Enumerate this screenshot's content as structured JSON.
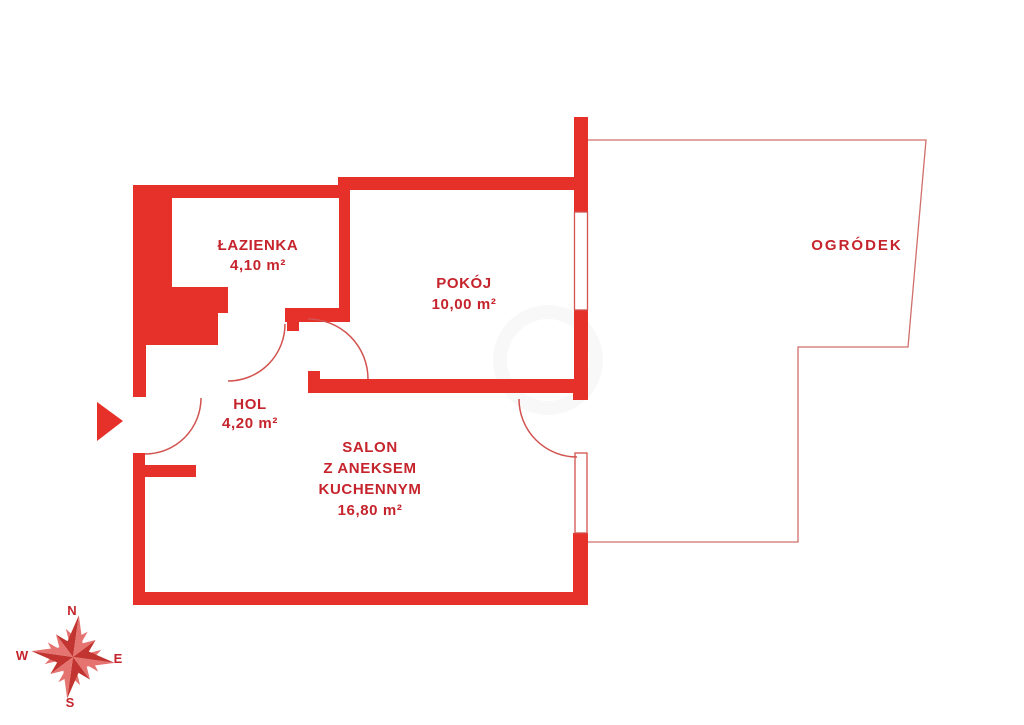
{
  "plan": {
    "rooms": [
      {
        "key": "lazienka",
        "label": "ŁAZIENKA",
        "area": "4,10 m²"
      },
      {
        "key": "pokoj",
        "label": "POKÓJ",
        "area": "10,00 m²"
      },
      {
        "key": "hol",
        "label": "HOL",
        "area": "4,20 m²"
      },
      {
        "key": "salon",
        "label_lines": [
          "SALON",
          "Z ANEKSEM",
          "KUCHENNYM"
        ],
        "area": "16,80 m²"
      },
      {
        "key": "ogrodek",
        "label": "OGRÓDEK"
      }
    ],
    "compass": {
      "north": "N",
      "east": "E",
      "south": "S",
      "west": "W"
    },
    "colors": {
      "wall": "#e6302a",
      "label": "#c6242c",
      "thin_line": "#d2534f",
      "garden_line": "#d06f6b",
      "compass_dark": "#c2342f",
      "compass_light": "#e57370"
    }
  }
}
